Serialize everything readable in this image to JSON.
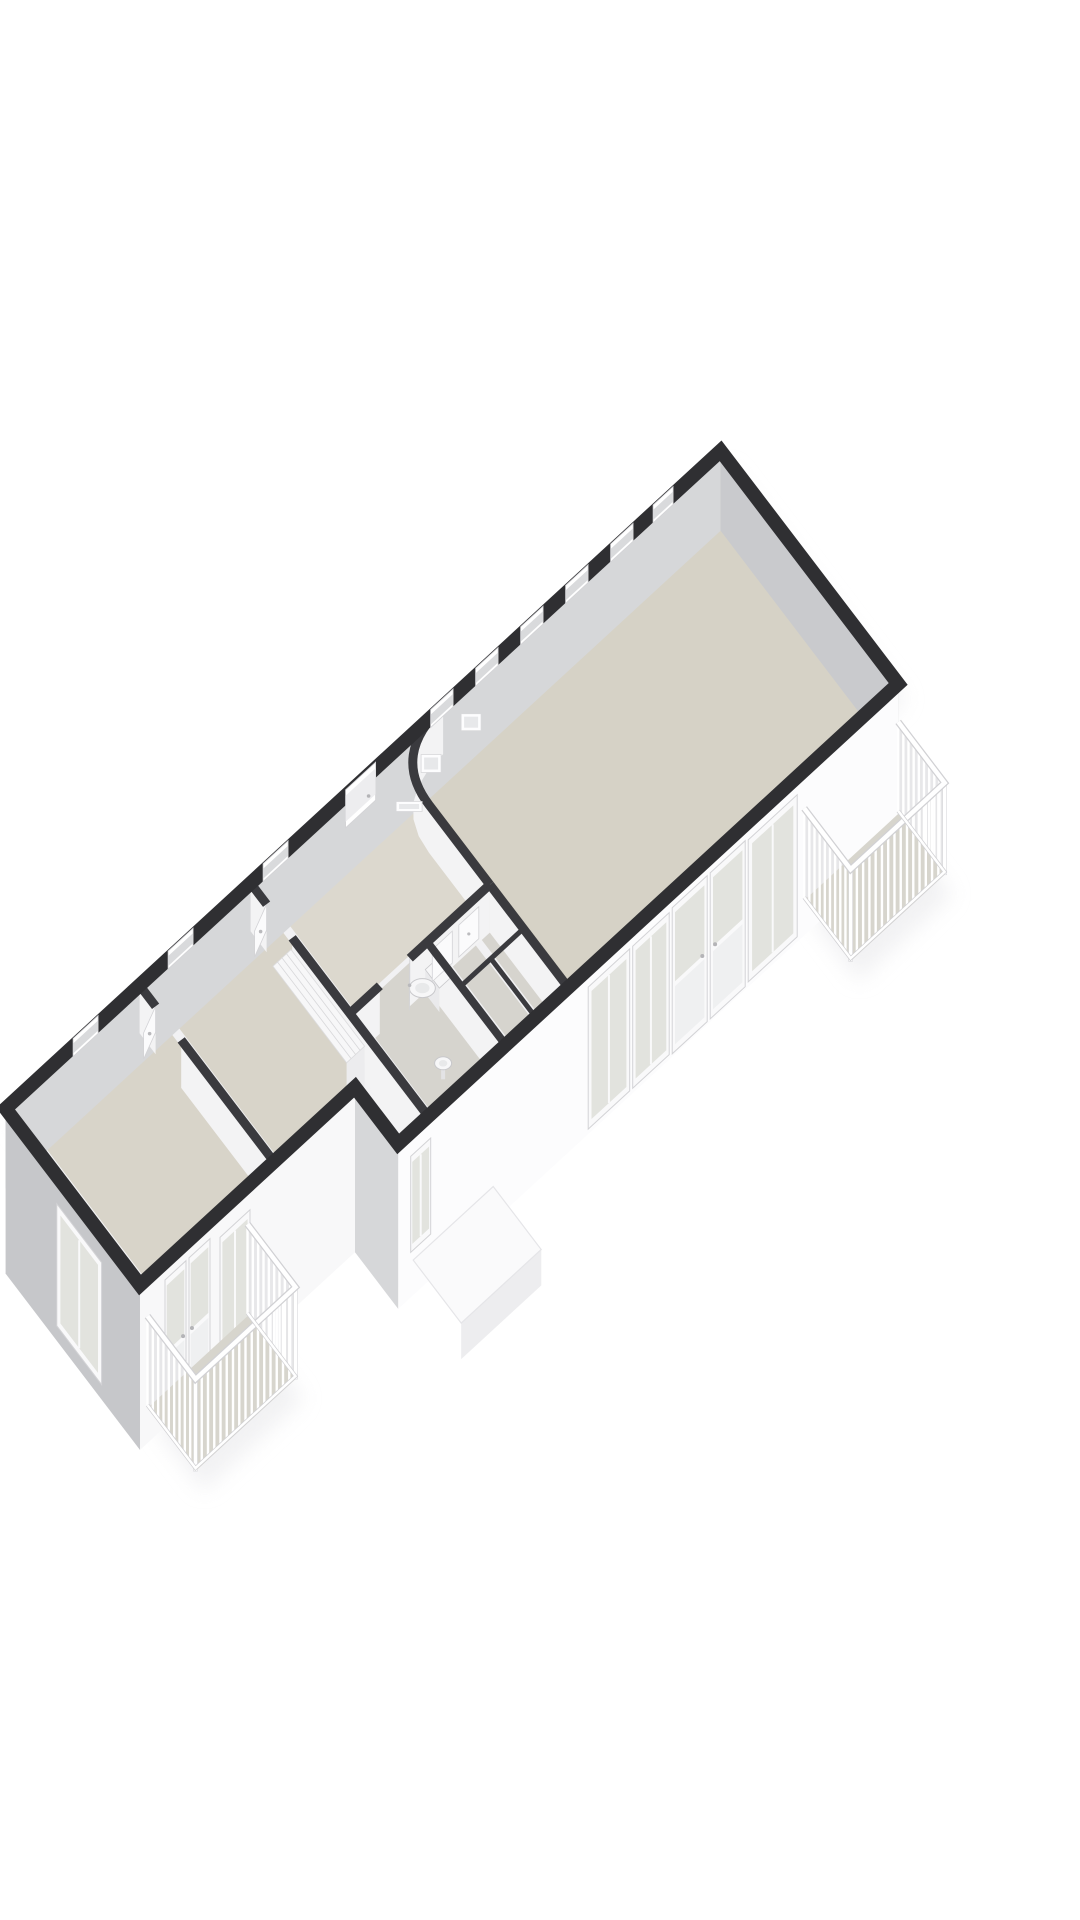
{
  "scene": {
    "background": "#ffffff",
    "canvas": {
      "width": 1080,
      "height": 1920
    },
    "iso": {
      "origin": [
        140,
        1285
      ],
      "e1": [
        50,
        -46
      ],
      "e2": [
        -32,
        -42
      ]
    },
    "metrics": {
      "facade_h": 165,
      "floor_off": 130,
      "rail_top": 38,
      "band_h": 80,
      "int_face_h": 48,
      "ext_stroke": 14,
      "bar_gap": 8
    }
  },
  "palette": {
    "wall_top": "#2f2f32",
    "wall_top_int": "#3a3a3e",
    "facade_main": "#fcfcfd",
    "facade_wing": "#f8f8f9",
    "facade_shade": "#c6c7ca",
    "facade_step": "#d6d7d9",
    "band_nw": "#d6d7d9",
    "band_ne": "#c9cacd",
    "int_face": "#f3f3f4",
    "floor_living": "#d6d2c6",
    "floor_bed": "#d8d4c9",
    "floor_hall": "#dcd8ce",
    "floor_bath": "#d6d4ce",
    "floor_balcony": "#d7d5cd",
    "glass": "#e2e3de",
    "frame": "#f9f9fa",
    "frame_edge": "#d3d3d6",
    "panel": "#eff0f1",
    "fixture": "#f7f7f8",
    "fixture_edge": "#c8c8cb",
    "fixture_inner": "#e8e9ea",
    "rail_bg": "#e4e4e7",
    "rail_bar": "#ffffff",
    "rail_edge": "#d1d1d4",
    "porch": "#fafafb",
    "porch_edge": "#e5e5e8",
    "shadow": "#e7e7ea",
    "opening_inner": "#d9dadc",
    "punched_inner": "#e7e8ea"
  },
  "footprint": {
    "outline": [
      [
        0,
        4.2
      ],
      [
        14.3,
        4.2
      ],
      [
        14.3,
        -1.35
      ],
      [
        4.3,
        -1.35
      ],
      [
        4.3,
        0
      ],
      [
        0,
        0
      ]
    ]
  },
  "floors": [
    {
      "id": "bedroom-1-floor",
      "rect": [
        0.12,
        0.1,
        2.62,
        4.1
      ],
      "fill": "floor_bed"
    },
    {
      "id": "bedroom-2-floor",
      "rect": [
        2.76,
        0.1,
        4.84,
        4.1
      ],
      "fill": "floor_bed"
    },
    {
      "id": "hallway-floor",
      "rect": [
        4.98,
        1.14,
        7.64,
        4.1
      ],
      "fill": "floor_hall"
    },
    {
      "id": "bathroom-floor",
      "rect": [
        4.98,
        -1.28,
        6.37,
        1.04
      ],
      "fill": "floor_bath"
    },
    {
      "id": "toilet-room-floor",
      "rect": [
        6.53,
        -1.28,
        6.99,
        1.04
      ],
      "fill": "floor_bath"
    },
    {
      "id": "storage-floor",
      "rect": [
        7.11,
        -1.28,
        7.64,
        1.04
      ],
      "fill": "floor_bath"
    },
    {
      "id": "living-room-floor",
      "rect": [
        7.76,
        -1.28,
        14.2,
        4.1
      ],
      "fill": "floor_living"
    }
  ],
  "bands": [
    {
      "id": "wall-face-nw",
      "from": [
        0,
        4.2
      ],
      "to": [
        14.3,
        4.2
      ],
      "fill": "band_nw"
    },
    {
      "id": "wall-face-ne",
      "from": [
        14.3,
        4.2
      ],
      "to": [
        14.3,
        -1.35
      ],
      "fill": "band_ne"
    }
  ],
  "nw_openings": {
    "windows": [
      [
        1.35,
        1.85
      ],
      [
        3.25,
        3.75
      ],
      [
        5.15,
        5.65
      ],
      [
        8.5,
        8.95
      ],
      [
        9.4,
        9.85
      ],
      [
        10.3,
        10.75
      ],
      [
        11.2,
        11.65
      ],
      [
        12.1,
        12.55
      ],
      [
        12.95,
        13.35
      ]
    ],
    "door": [
      6.8,
      7.4
    ]
  },
  "nw_punched": {
    "squares": [
      [
        8.35,
        30,
        20,
        18
      ],
      [
        9.15,
        26,
        20,
        17
      ]
    ],
    "slit": [
      7.85,
      54,
      26,
      10
    ]
  },
  "interior_faces": [
    [
      4.9,
      -1.35,
      4.9,
      2.9
    ],
    [
      4.9,
      3.7,
      4.9,
      4.2
    ],
    [
      2.68,
      0,
      2.68,
      2.9
    ],
    [
      2.68,
      3.7,
      2.68,
      4.2
    ],
    [
      4.9,
      1.1,
      5.5,
      1.1
    ],
    [
      6.1,
      1.1,
      7.7,
      1.1
    ],
    [
      6.45,
      -1.35,
      6.45,
      1.1
    ],
    [
      7.7,
      -1.35,
      7.7,
      1.1
    ]
  ],
  "interior_walls": [
    [
      4.9,
      -1.35,
      4.9,
      2.9,
      9
    ],
    [
      4.9,
      3.7,
      4.9,
      4.2,
      9
    ],
    [
      2.68,
      0,
      2.68,
      2.9,
      9
    ],
    [
      2.68,
      3.7,
      2.68,
      4.2,
      9
    ],
    [
      4.9,
      1.1,
      5.5,
      1.1,
      9
    ],
    [
      6.1,
      1.1,
      7.7,
      1.1,
      9
    ],
    [
      6.45,
      -1.35,
      6.45,
      1.1,
      8
    ],
    [
      7.7,
      -1.35,
      7.7,
      1.1,
      9
    ],
    [
      7.05,
      -1.25,
      7.05,
      0.05,
      5
    ],
    [
      6.45,
      0.05,
      7.7,
      0.05,
      5
    ]
  ],
  "curved_wall": {
    "start": [
      7.7,
      1.1
    ],
    "corner": [
      7.7,
      3.0
    ],
    "ctrl": [
      7.7,
      4.2
    ],
    "end": [
      8.75,
      4.2
    ]
  },
  "facades": [
    {
      "id": "facade-se-main",
      "from": [
        4.3,
        -1.35
      ],
      "to": [
        14.3,
        -1.35
      ],
      "fill": "facade_main"
    },
    {
      "id": "facade-se-step",
      "from": [
        4.3,
        0
      ],
      "to": [
        4.3,
        -1.35
      ],
      "fill": "facade_step"
    },
    {
      "id": "facade-se-wing",
      "from": [
        0,
        0
      ],
      "to": [
        4.3,
        0
      ],
      "fill": "facade_wing"
    },
    {
      "id": "facade-sw",
      "from": [
        0,
        4.2
      ],
      "to": [
        0,
        0
      ],
      "fill": "facade_shade"
    }
  ],
  "facade_windows": [
    {
      "id": "living-window-1",
      "a": [
        8.1,
        -1.35
      ],
      "b": [
        8.93,
        -1.35
      ],
      "top": 18,
      "bottom": 160,
      "type": "window"
    },
    {
      "id": "living-window-2",
      "a": [
        8.99,
        -1.35
      ],
      "b": [
        9.72,
        -1.35
      ],
      "top": 18,
      "bottom": 160,
      "type": "window"
    },
    {
      "id": "living-balcony-door-left",
      "a": [
        9.78,
        -1.35
      ],
      "b": [
        10.48,
        -1.35
      ],
      "top": 16,
      "bottom": 162,
      "type": "door",
      "handle": "end"
    },
    {
      "id": "living-balcony-door-right",
      "a": [
        10.54,
        -1.35
      ],
      "b": [
        11.24,
        -1.35
      ],
      "top": 16,
      "bottom": 162,
      "type": "door",
      "handle": "start"
    },
    {
      "id": "living-window-3",
      "a": [
        11.3,
        -1.35
      ],
      "b": [
        12.28,
        -1.35
      ],
      "top": 18,
      "bottom": 160,
      "type": "window"
    },
    {
      "id": "bedroom2-window",
      "a": [
        4.55,
        -1.35
      ],
      "b": [
        4.95,
        -1.35
      ],
      "top": 24,
      "bottom": 120,
      "type": "window"
    },
    {
      "id": "wing-balcony-door-left",
      "a": [
        0.5,
        0
      ],
      "b": [
        0.92,
        0
      ],
      "top": 18,
      "bottom": 158,
      "type": "door",
      "handle": "end"
    },
    {
      "id": "wing-balcony-door-right",
      "a": [
        0.98,
        0
      ],
      "b": [
        1.4,
        0
      ],
      "top": 18,
      "bottom": 158,
      "type": "door",
      "handle": "start"
    },
    {
      "id": "wing-window",
      "a": [
        1.6,
        0
      ],
      "b": [
        2.2,
        0
      ],
      "top": 26,
      "bottom": 140,
      "type": "window"
    },
    {
      "id": "bedroom1-sw-window",
      "a": [
        0,
        1.2
      ],
      "b": [
        0,
        2.6
      ],
      "top": 28,
      "bottom": 150,
      "type": "window"
    }
  ],
  "doors": [
    {
      "id": "bedroom-1-door",
      "hinge": [
        2.68,
        3.7
      ],
      "tip": [
        2.3,
        3.48
      ]
    },
    {
      "id": "bedroom-2-door",
      "hinge": [
        4.9,
        3.7
      ],
      "tip": [
        4.52,
        3.48
      ]
    },
    {
      "id": "bathroom-door",
      "hinge": [
        6.1,
        1.1
      ],
      "tip": [
        5.86,
        0.74
      ]
    }
  ],
  "closet_doors": [
    {
      "id": "closet-door-1",
      "a": [
        6.55,
        1.1
      ],
      "b": [
        6.95,
        1.1
      ]
    },
    {
      "id": "closet-door-2",
      "a": [
        7.08,
        1.1
      ],
      "b": [
        7.48,
        1.1
      ]
    }
  ],
  "fixtures": {
    "wardrobe": {
      "rect": [
        4.42,
        0.45,
        4.78,
        2.75
      ],
      "seams": 3
    },
    "toilet": {
      "tank": [
        6.18,
        0.3,
        6.4,
        0.74
      ],
      "bowl": [
        5.98,
        0.52
      ],
      "rx": 13,
      "ry": 9.5
    },
    "sink": {
      "center": [
        5.55,
        -0.8
      ],
      "rx": 8.5,
      "ry": 6.5
    }
  },
  "balconies": [
    {
      "id": "balcony-southwest",
      "attach_a": [
        0.15,
        0
      ],
      "attach_b": [
        2.15,
        0
      ],
      "depth": -1.5
    },
    {
      "id": "balcony-east",
      "attach_a": [
        12.42,
        -1.35
      ],
      "attach_b": [
        14.3,
        -1.35
      ],
      "depth": -1.45
    }
  ],
  "porch": {
    "rect": [
      4.6,
      -1.35,
      6.2,
      -2.85
    ],
    "drop": 130,
    "face_h": 36
  }
}
